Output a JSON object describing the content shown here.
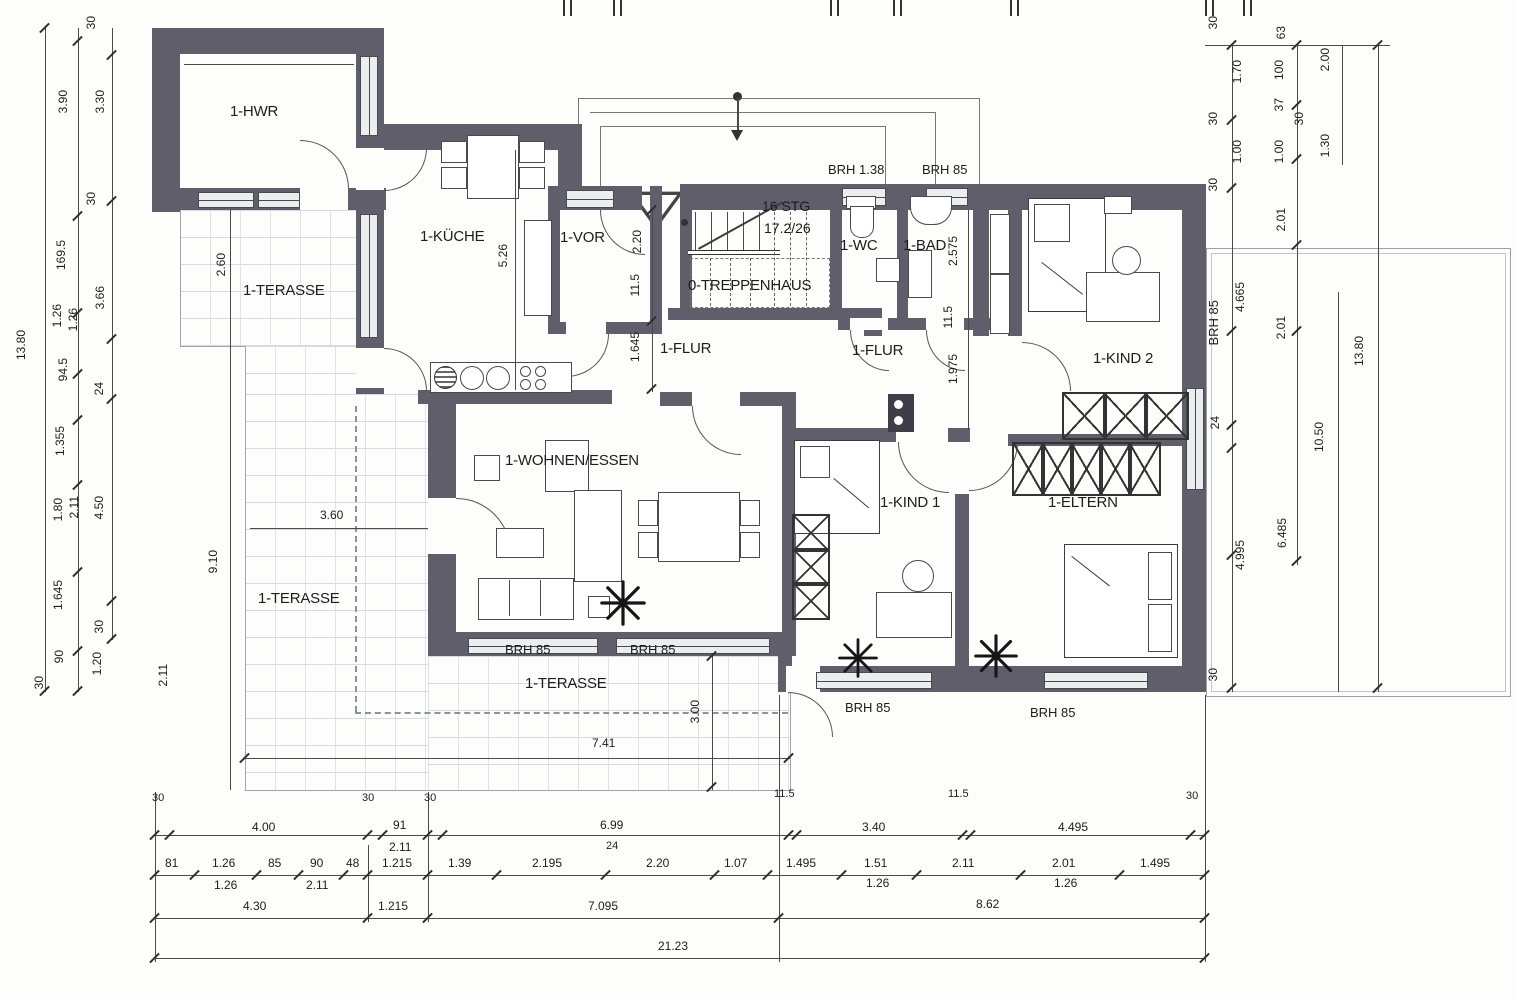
{
  "colors": {
    "wall": "#615e6c",
    "line": "#4a4a4a",
    "paving": "#ccd3d8",
    "window_fill": "#eaeef1"
  },
  "rooms": {
    "hwr": "1-HWR",
    "kueche": "1-KÜCHE",
    "vor": "1-VOR",
    "treppenhaus": "0-TREPPENHAUS",
    "wc": "1-WC",
    "bad": "1-BAD",
    "kind2": "1-KIND 2",
    "flur_links": "1-FLUR",
    "flur_rechts": "1-FLUR",
    "wohnen": "1-WOHNEN/ESSEN",
    "kind1": "1-KIND 1",
    "eltern": "1-ELTERN",
    "terrasse_oben": "1-TERASSE",
    "terrasse_links": "1-TERASSE",
    "terrasse_unten": "1-TERASSE"
  },
  "stairs": {
    "count": "16 STG",
    "ratio": "17.2/26"
  },
  "brh": {
    "wc": "BRH 1.38",
    "bad": "BRH 85",
    "kind2": "BRH 85",
    "wohnen_l": "BRH 85",
    "wohnen_r": "BRH 85",
    "kind1": "BRH 85",
    "eltern": "BRH 85"
  },
  "dims": {
    "left": [
      "30",
      "3.90",
      "3.30",
      "30",
      "169.5",
      "3.66",
      "1.26",
      "1.26",
      "94.5",
      "24",
      "1.355",
      "1.80",
      "2.11",
      "4.50",
      "1.645",
      "30",
      "90",
      "1.20",
      "30",
      "13.80",
      "2.60",
      "9.10",
      "2.11",
      "3.60"
    ],
    "right_top": [
      "30",
      "63",
      "2.00",
      "1.70",
      "100",
      "30",
      "37",
      "30",
      "1.00",
      "1.00",
      "1.30",
      "30",
      "2.01"
    ],
    "right": [
      "4.665",
      "2.01",
      "13.80",
      "24",
      "10.50",
      "4.995",
      "6.485",
      "30"
    ],
    "bottom_row1": [
      "30",
      "4.00",
      "30",
      "91",
      "2.11",
      "30",
      "6.99",
      "24",
      "11.5",
      "3.40",
      "11.5",
      "4.495",
      "30"
    ],
    "bottom_row2": [
      "81",
      "1.26",
      "1.26",
      "85",
      "90",
      "2.11",
      "48",
      "1.215",
      "1.39",
      "2.195",
      "2.20",
      "1.07",
      "1.495",
      "1.51",
      "1.26",
      "2.11",
      "2.01",
      "1.26",
      "1.495"
    ],
    "bottom_row3": [
      "4.30",
      "1.215",
      "7.095",
      "8.62"
    ],
    "bottom_total": "21.23",
    "inner": [
      "5.26",
      "2.20",
      "11.5",
      "1.645",
      "2.575",
      "11.5",
      "1.975",
      "7.41",
      "3.00"
    ]
  }
}
